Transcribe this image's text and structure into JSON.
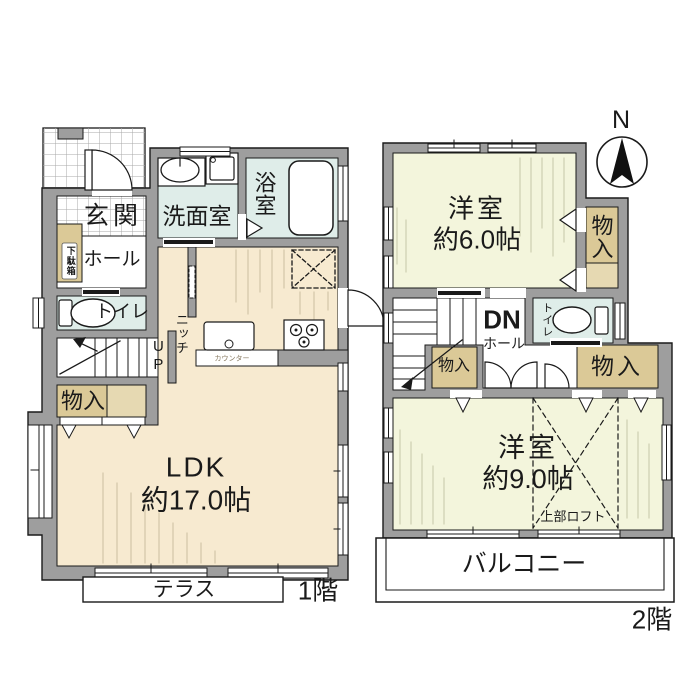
{
  "plan": {
    "floor1": {
      "floor_label": "1階",
      "entrance": "玄関",
      "shoe_cabinet": "下駄箱",
      "hall": "ホール",
      "toilet": "トイレ",
      "stairs_up": "UP",
      "storage": "物入",
      "washroom": "洗面室",
      "bathroom": "浴室",
      "niche": "ニッチ",
      "kitchen_counter": "カウンター",
      "ldk_name": "LDK",
      "ldk_size": "約17.0帖",
      "terrace": "テラス"
    },
    "floor2": {
      "floor_label": "2階",
      "bedroom6_name": "洋室",
      "bedroom6_size": "約6.0帖",
      "storage_upper_right": "物入",
      "stairs_down": "DN",
      "hall": "ホール",
      "toilet": "トイレ",
      "storage_hall_left": "物入",
      "storage_hall_right": "物入",
      "bedroom9_name": "洋室",
      "bedroom9_size": "約9.0帖",
      "loft": "上部ロフト",
      "balcony": "バルコニー",
      "compass_north": "N"
    },
    "colors": {
      "wall_gray": "#9e9e9e",
      "flooring_cream": "#f7ead0",
      "flooring_pale_yellow": "#f3f5dc",
      "wet_area_blue": "#dfede9",
      "storage_tan": "#dbc997",
      "storage_tan_light": "#e6d9b2",
      "line_black": "#1a1a1a"
    }
  }
}
